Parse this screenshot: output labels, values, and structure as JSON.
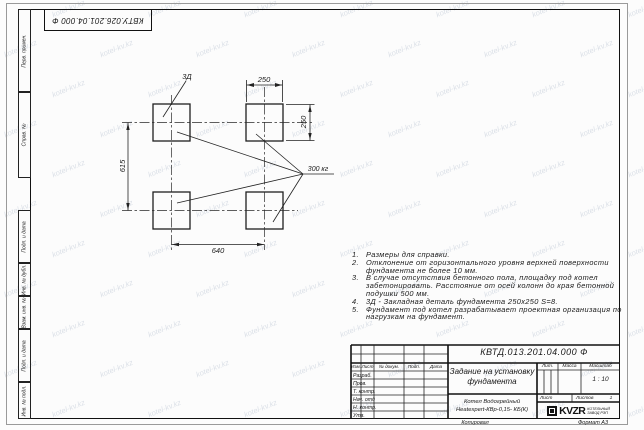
{
  "watermark": {
    "text": "kotel-kv.kz"
  },
  "top_stamp": {
    "text": "КВТУ.026.201.04.000 Ф"
  },
  "margin_labels": [
    "Перв. примен.",
    "Справ. №",
    "Подп. и дата",
    "Инв. № дубл.",
    "Взам. инв. №",
    "Подп. и дата",
    "Инв. № подл."
  ],
  "drawing": {
    "dim_top": "250",
    "dim_right": "250",
    "dim_left": "615",
    "dim_bottom": "640",
    "load_label": "300 кг",
    "embed_label": "3Д"
  },
  "notes": [
    {
      "num": "1.",
      "lines": [
        "Размеры для справки."
      ]
    },
    {
      "num": "2.",
      "lines": [
        "Отклонение от горизонтального уровня верхней поверхности",
        "фундамента не более 10 мм."
      ]
    },
    {
      "num": "3.",
      "lines": [
        "В случае отсутствия бетонного пола, площадку под котел",
        "забетонировать. Расстояние от осей колонн до края бетонной",
        "подушки 500 мм."
      ]
    },
    {
      "num": "4.",
      "lines": [
        "3Д - Закладная деталь фундамента 250х250 S=8."
      ]
    },
    {
      "num": "5.",
      "lines": [
        "Фундамент под котел разрабатывает проектная организация по",
        "нагрузкам на фундамент."
      ]
    }
  ],
  "title_block": {
    "designation": "КВТД.013.201.04.000 Ф",
    "title": "Задание на установку фундамента",
    "product_line1": "Котел Водогрейный",
    "product_line2": "Heatexpert-КВр-0,15- КБ(К)",
    "header_cols": [
      "Изм.",
      "Лист",
      "№ докум.",
      "Подп.",
      "Дата"
    ],
    "sig_rows": [
      "Разраб.",
      "Пров.",
      "Т. контр.",
      "Нач. отд",
      "Н. контр.",
      "Утв."
    ],
    "lit_label": "Лит.",
    "mass_label": "Масса",
    "scale_label": "Масштаб",
    "scale_value": "1 : 10",
    "sheet_label": "Лист",
    "sheets_label": "Листов",
    "sheets_value": "1",
    "company": {
      "logo": "KVZR",
      "tagline_line1": "КОТЕЛЬНЫЙ",
      "tagline_line2": "ЗАВОД РЭП"
    }
  },
  "footer": {
    "copy": "Копировал",
    "format": "Формат А3"
  }
}
